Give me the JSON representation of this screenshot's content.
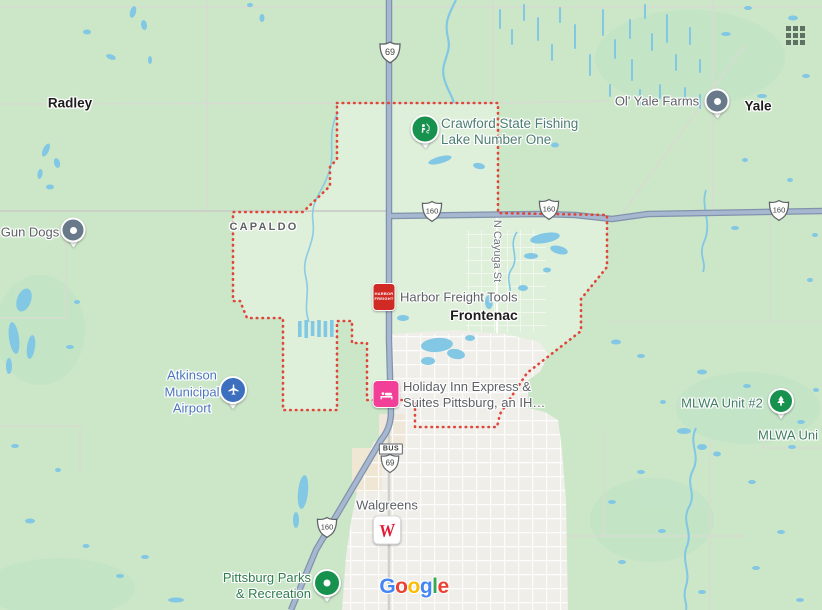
{
  "labels": {
    "radley": "Radley",
    "yale": "Yale",
    "frontenac": "Frontenac",
    "capaldo": "CAPALDO",
    "gun_dogs": "Gun Dogs",
    "ol_yale_farms": "Ol' Yale Farms",
    "crawford_l1": "Crawford State Fishing",
    "crawford_l2": "Lake Number One",
    "harbor_freight": "Harbor Freight Tools",
    "holiday_l1": "Holiday Inn Express &",
    "holiday_l2": "Suites Pittsburg, an IH…",
    "atkinson_l1": "Atkinson",
    "atkinson_l2": "Municipal",
    "atkinson_l3": "Airport",
    "mlwa_unit2": "MLWA Unit #2",
    "mlwa_cut": "MLWA Uni",
    "walgreens": "Walgreens",
    "parks_l1": "Pittsburg Parks",
    "parks_l2": "& Recreation",
    "n_cayuga": "N Cayuga St"
  },
  "shields": {
    "us69": "69",
    "r160": "160",
    "bus": "BUS"
  },
  "brand_icons": {
    "harbor_l1": "HARBOR",
    "harbor_l2": "FREIGHT",
    "walgreens_w": "W"
  },
  "google_logo": {
    "letters": [
      "G",
      "o",
      "o",
      "g",
      "l",
      "e"
    ],
    "colors": [
      "#4285F4",
      "#EA4335",
      "#FBBC05",
      "#4285F4",
      "#34A853",
      "#EA4335"
    ]
  },
  "icons": {
    "apps_grid": "3x3-dot-grid",
    "pin_generic": "gray-circle-dot-pin",
    "pin_parks": "green-circle-dot-pin",
    "pin_fishing": "green-angler-pin",
    "pin_nature": "green-pine-tree-pin",
    "pin_airport": "blue-airplane-pin",
    "harbor_freight_logo": "red-square",
    "holiday_inn_logo": "pink-bed-square",
    "walgreens_logo": "white-square-red-w"
  },
  "colors": {
    "land": "#cbe7c8",
    "city_boundary_fill": "#def0da",
    "boundary_red": "#e0453a",
    "water_blue": "#82c7e4",
    "highway_fill": "#a6b8cf",
    "highway_casing": "#8292ad",
    "minor_road": "#d7dbd1",
    "city_fill": "#f0eee9",
    "town_text": "#1d1d1d",
    "poi_text": "#5d6165",
    "park_text": "#2e7d4c",
    "nature_text": "#3f7e63",
    "water_rec_text": "#4d7e71",
    "airport_text": "#4a77bc",
    "street_text": "#70757a",
    "harbor_red": "#cf2b24",
    "lodging_pink": "#f23f97",
    "airport_blue": "#3c6fbe",
    "nature_green": "#17914e",
    "pin_gray": "#68798a",
    "walgreens_red": "#e31837"
  }
}
